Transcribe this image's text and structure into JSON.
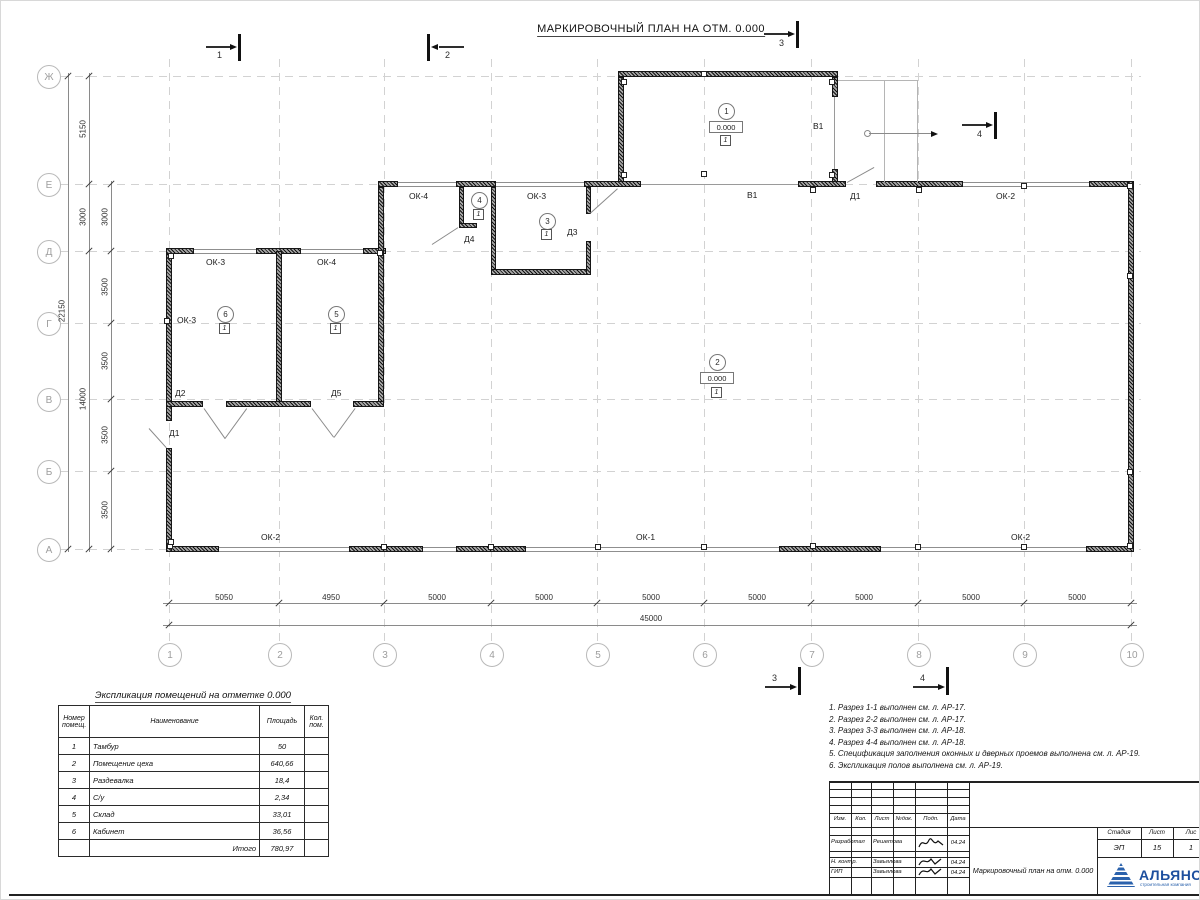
{
  "title": "МАРКИРОВОЧНЫЙ ПЛАН НА ОТМ. 0.000",
  "axes": {
    "rows": [
      "Ж",
      "Е",
      "Д",
      "Г",
      "В",
      "Б",
      "А"
    ],
    "cols": [
      "1",
      "2",
      "3",
      "4",
      "5",
      "6",
      "7",
      "8",
      "9",
      "10"
    ]
  },
  "dims": {
    "left_total": "22150",
    "left_mid": [
      "5150",
      "3000",
      "14000"
    ],
    "left_inner": [
      "3000",
      "3500",
      "3500",
      "3500",
      "3500"
    ],
    "bottom": [
      "5050",
      "4950",
      "5000",
      "5000",
      "5000",
      "5000",
      "5000",
      "5000",
      "5000"
    ],
    "bottom_total": "45000"
  },
  "sections": [
    "1",
    "2",
    "3",
    "4"
  ],
  "openings": {
    "ok4_top": "ОК-4",
    "ok3_top": "ОК-3",
    "d1_top": "Д1",
    "v1_bottom": "В1",
    "v1_side": "В1",
    "ok2_top_right": "ОК-2",
    "ok3_d1": "ОК-3",
    "ok4_d2": "ОК-4",
    "ok3_left": "ОК-3",
    "d2": "Д2",
    "d5": "Д5",
    "d1_left": "Д1",
    "d3": "Д3",
    "d4": "Д4",
    "ok2_bottom_left": "ОК-2",
    "ok1_bottom": "ОК-1",
    "ok2_bottom_right": "ОК-2"
  },
  "rooms": [
    {
      "num": "1",
      "elev": "0.000",
      "floor": "1"
    },
    {
      "num": "2",
      "elev": "0.000",
      "floor": "1"
    },
    {
      "num": "3",
      "floor": "1"
    },
    {
      "num": "4",
      "floor": "1"
    },
    {
      "num": "5",
      "floor": "1"
    },
    {
      "num": "6",
      "floor": "1"
    }
  ],
  "explication": {
    "title": "Экспликация помещений на отметке 0.000",
    "headers": {
      "num": "Номер\nпомещ.",
      "name": "Наименование",
      "area": "Площадь",
      "count": "Кол.\nпом."
    },
    "rows": [
      [
        "1",
        "Тамбур",
        "50"
      ],
      [
        "2",
        "Помещение цеха",
        "640,66"
      ],
      [
        "3",
        "Раздевалка",
        "18,4"
      ],
      [
        "4",
        "С/у",
        "2,34"
      ],
      [
        "5",
        "Склад",
        "33,01"
      ],
      [
        "6",
        "Кабинет",
        "36,56"
      ]
    ],
    "total_label": "Итого",
    "total_value": "780,97"
  },
  "notes": [
    "1. Разрез 1-1 выполнен см. л. АР-17.",
    "2. Разрез 2-2 выполнен см. л. АР-17.",
    "3. Разрез 3-3 выполнен см. л. АР-18.",
    "4. Разрез 4-4 выполнен см. л. АР-18.",
    "5. Спецификация заполнения оконных и дверных проемов выполнена см. л. АР-19.",
    "6. Экспликация полов выполнена см. л. АР-19."
  ],
  "titleblock": {
    "cols": [
      "Изм.",
      "Кол.",
      "Лист",
      "№док.",
      "Подп.",
      "Дата"
    ],
    "rows": [
      {
        "role": "Разработал",
        "name": "Решетова",
        "date": "04.24"
      },
      {
        "role": "Н. контр.",
        "name": "Завьялова",
        "date": "04.24"
      },
      {
        "role": "ГИП",
        "name": "Завьялова",
        "date": "04.24"
      }
    ],
    "doc_title": "Маркировочный план на отм. 0.000",
    "stage_label": "Стадия",
    "sheet_label": "Лист",
    "sheets_label": "Лис",
    "stage_value": "ЭП",
    "sheet_value": "15",
    "sheets_value": "1",
    "company": "АЛЬЯНС",
    "company_sub": "строительная компания"
  }
}
